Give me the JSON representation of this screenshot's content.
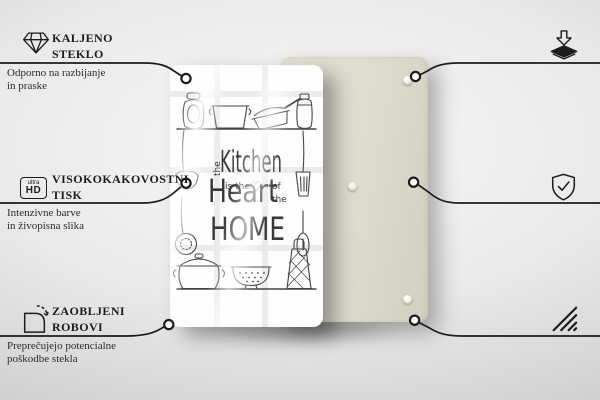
{
  "colors": {
    "connector_line": "#1c1c1c",
    "callout_text": "#1d1d1d",
    "front_panel": "#fdfdfd",
    "back_panel": "#dedbce",
    "artwork_ink": "#454545"
  },
  "callouts": {
    "top_left": {
      "icon": "diamond-icon",
      "title_line1": "KALJENO",
      "title_line2": "STEKLO",
      "desc_line1": "Odporno na razbijanje",
      "desc_line2": "in praske"
    },
    "mid_left": {
      "icon": "ultra-hd-icon",
      "icon_label_top": "ultra",
      "icon_label_bottom": "HD",
      "title_line1": "VISOKOKAKOVOSTNI",
      "title_line2": "TISK",
      "desc_line1": "Intenzivne barve",
      "desc_line2": "in živopisna slika"
    },
    "bottom_left": {
      "icon": "rounded-corner-icon",
      "title_line1": "ZAOBLJENI",
      "title_line2": "ROBOVI",
      "desc_line1": "Preprečujejo potencialne",
      "desc_line2": "poškodbe stekla"
    },
    "top_right": {
      "icon": "anti-slip-pads-icon",
      "title_line1": "PROTIDRSNE",
      "title_line2": "PODLOGE",
      "desc_line1": "Samolepilne gumijaste blazinice",
      "desc_line2": "priložene v kompletu"
    },
    "mid_right": {
      "icon": "shield-check-icon",
      "title_line1": "ZAŠČITNA",
      "title_line2": "FOLIJA",
      "desc_line1": "Ščiti zadnji del izdelka"
    },
    "bottom_right": {
      "icon": "polished-edges-icon",
      "title_line1": "POLIRANI",
      "title_line2": "ROBOVI",
      "desc_line1": "Gladka in varna",
      "desc_line2": "končna obdelava"
    }
  },
  "artwork": {
    "the_vertical": "the",
    "kitchen": "Kitchen",
    "is_the": "is the",
    "heart_symbol": "♡",
    "of": "of",
    "the_small": "the",
    "heart": "Heart",
    "home": "HOME"
  }
}
